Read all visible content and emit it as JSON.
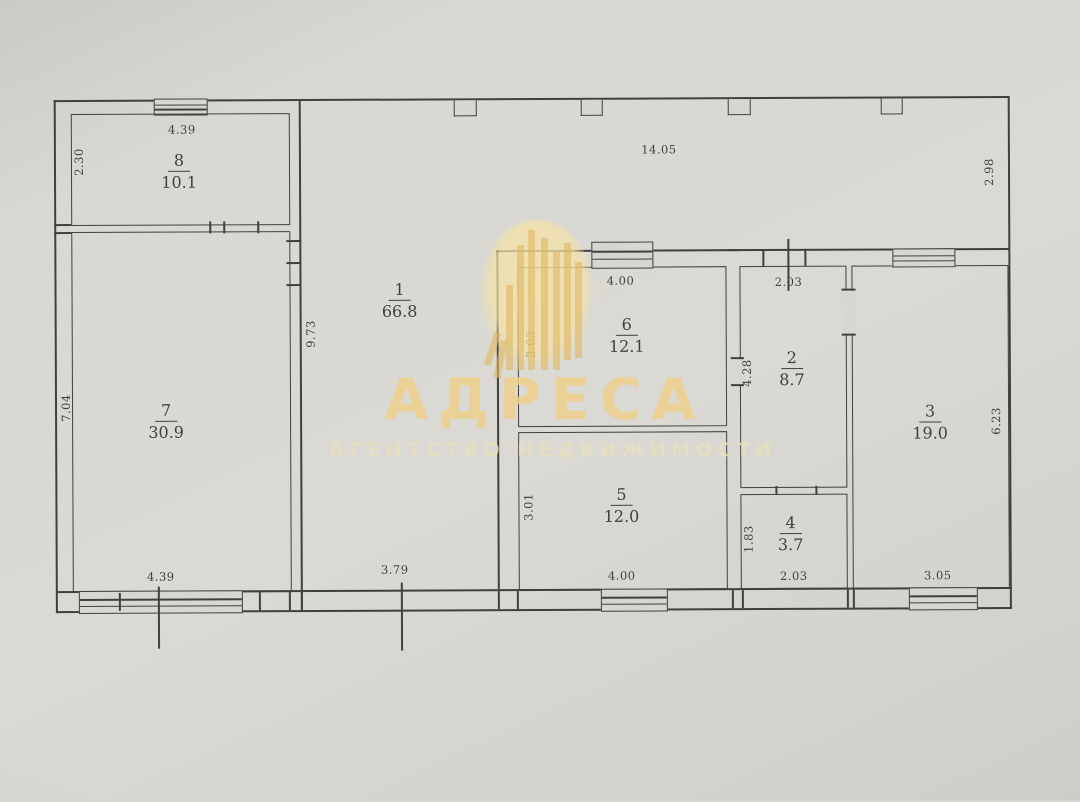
{
  "watermark": {
    "brand": "АДРЕСА",
    "tagline": "АГЕНТСТВО НЕДВИЖИМОСТИ"
  },
  "rooms": {
    "r1": {
      "number": "1",
      "area": "66.8"
    },
    "r2": {
      "number": "2",
      "area": "8.7"
    },
    "r3": {
      "number": "3",
      "area": "19.0"
    },
    "r4": {
      "number": "4",
      "area": "3.7"
    },
    "r5": {
      "number": "5",
      "area": "12.0"
    },
    "r6": {
      "number": "6",
      "area": "12.1"
    },
    "r7": {
      "number": "7",
      "area": "30.9"
    },
    "r8": {
      "number": "8",
      "area": "10.1"
    }
  },
  "dims": {
    "room8_top": "4.39",
    "room8_left": "2.30",
    "top_width": "14.05",
    "right_height": "2.98",
    "room1_wall": "9.73",
    "room7_left": "7.04",
    "room7_bottom": "4.39",
    "room1_bottom": "3.79",
    "room6_top": "4.00",
    "room6_left": "3.03",
    "room5_left": "3.01",
    "room5_bottom": "4.00",
    "room2_top": "2.03",
    "room2_left": "4.28",
    "room4_left": "1.83",
    "room4_bottom": "2.03",
    "room3_right": "6.23",
    "room3_bottom": "3.05"
  },
  "colors": {
    "paper": "#d7d6d0",
    "ink": "#41403b",
    "brand": "#f0d08a",
    "tagline": "#e8e0be"
  }
}
